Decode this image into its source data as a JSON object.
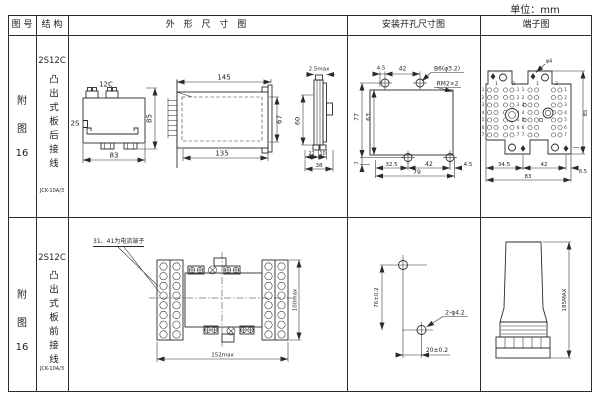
{
  "unit_label": "单位：mm",
  "header": {
    "fig_no": "图 号",
    "structure": "结 构",
    "outline": "外 形 尺 寸 图",
    "mounting": "安装开孔尺寸图",
    "terminal": "端子图"
  },
  "rows": [
    {
      "fig_chars": [
        "附",
        "图",
        "16"
      ],
      "model": "2S12C",
      "structure_text": "凸出式板后接线",
      "type_code": "JCK-10A/3",
      "outline": {
        "front": {
          "top": "12C",
          "left": "2S",
          "width": "83",
          "height": "85"
        },
        "side": {
          "depth_total": "145",
          "depth_body": "135",
          "height": "67"
        },
        "edge": {
          "thickness": "2.5max",
          "height": "60",
          "d1": "22",
          "d2": "10",
          "d3": "38"
        }
      },
      "mounting": {
        "t1": "4.5",
        "t2": "42",
        "hole": "B6(φ3.2)",
        "thread": "RM2×2",
        "v_outer": "77",
        "v_inner": "63",
        "v_small": "7",
        "b1": "32.5",
        "b2": "42",
        "b3": "4.5",
        "b_total": "79"
      },
      "terminal": {
        "hole": "φ4",
        "top_nums": [
          "1",
          "2",
          "1",
          "2"
        ],
        "row_nums": [
          "1",
          "2",
          "3",
          "4",
          "5",
          "6",
          "7"
        ],
        "height": "85",
        "ear": "4",
        "b1": "34.5",
        "b2": "42",
        "b3": "6.5",
        "b_total": "83"
      }
    },
    {
      "fig_chars": [
        "附",
        "图",
        "16"
      ],
      "model": "2S12C",
      "structure_text": "凸出式板前接线",
      "type_code": "JCK-10A/3",
      "outline": {
        "note": "31、41为电流端子",
        "width": "152max",
        "height": "100max"
      },
      "mounting": {
        "v": "76±0.2",
        "hole": "2-φ4.2",
        "h": "20±0.2"
      },
      "side_view": {
        "height": "185MAX"
      }
    }
  ]
}
